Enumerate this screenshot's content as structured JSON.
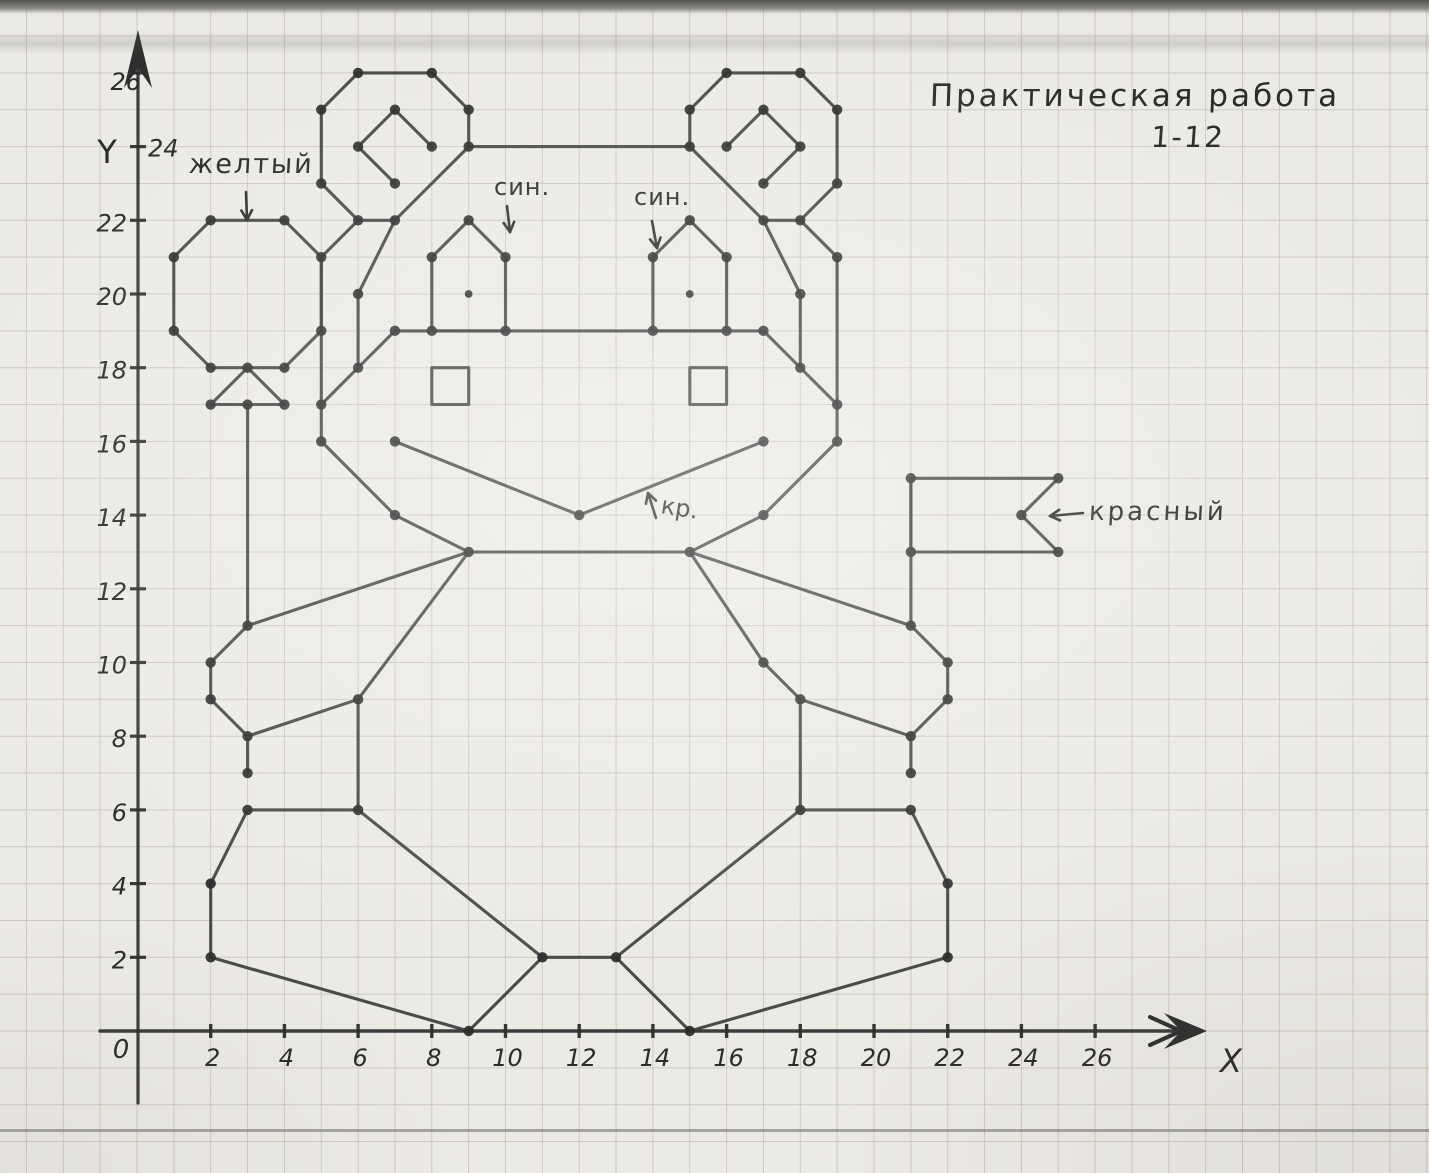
{
  "page": {
    "paper_color": "#eceae5",
    "grid_color": "#c8c5bf",
    "pencil_color": "#3a3a3a",
    "dot_color": "#2c2c2c",
    "text_color": "#2b2b2b"
  },
  "title": {
    "line1": "Практическая работа",
    "line2": "1-12"
  },
  "axes": {
    "x_letter": "X",
    "y_letter": "Y",
    "origin_label": "0",
    "x_tick_labels": [
      2,
      4,
      6,
      8,
      10,
      12,
      14,
      16,
      18,
      20,
      22,
      24,
      26
    ],
    "y_tick_labels": [
      2,
      4,
      6,
      8,
      10,
      12,
      14,
      16,
      18,
      20,
      22,
      24,
      26
    ],
    "origin_px": [
      137,
      1031
    ],
    "unit_px": 36.85
  },
  "annotations": [
    {
      "name": "label-yellow",
      "text": "желтый",
      "arrow": [
        [
          246,
          192
        ],
        [
          247,
          220
        ]
      ]
    },
    {
      "name": "label-blue-left",
      "text": "син.",
      "arrow": [
        [
          507,
          206
        ],
        [
          510,
          232
        ]
      ]
    },
    {
      "name": "label-blue-right",
      "text": "син.",
      "arrow": [
        [
          652,
          221
        ],
        [
          657,
          248
        ]
      ]
    },
    {
      "name": "label-red-mouth",
      "text": "кр.",
      "arrow": [
        [
          656,
          518
        ],
        [
          648,
          493
        ]
      ]
    },
    {
      "name": "label-red-flag",
      "text": "красный",
      "arrow": [
        [
          1083,
          513
        ],
        [
          1050,
          516
        ]
      ]
    }
  ],
  "chart_data": {
    "type": "line",
    "title": "Практическая работа 1-12",
    "description": "Hand-drawn connect-the-dots coordinate drawing on graph paper: a teddy bear holding a yellow balloon and a red flag",
    "xlabel": "X",
    "ylabel": "Y",
    "xlim": [
      0,
      29
    ],
    "ylim": [
      0,
      27
    ],
    "grid": true,
    "figures": [
      {
        "name": "balloon",
        "closed": true,
        "dots": true,
        "points": [
          [
            2,
            22
          ],
          [
            4,
            22
          ],
          [
            5,
            21
          ],
          [
            5,
            19
          ],
          [
            4,
            18
          ],
          [
            2,
            18
          ],
          [
            1,
            19
          ],
          [
            1,
            21
          ]
        ]
      },
      {
        "name": "balloon-knot",
        "closed": true,
        "dots": true,
        "points": [
          [
            3,
            18
          ],
          [
            4,
            17
          ],
          [
            2,
            17
          ]
        ]
      },
      {
        "name": "balloon-string",
        "closed": false,
        "dots": true,
        "points": [
          [
            3,
            17
          ],
          [
            3,
            11
          ]
        ]
      },
      {
        "name": "string-end-left",
        "closed": false,
        "dots": true,
        "points": [
          [
            3,
            8
          ],
          [
            3,
            7
          ]
        ]
      },
      {
        "name": "left-ear",
        "closed": true,
        "dots": true,
        "points": [
          [
            5,
            25
          ],
          [
            6,
            26
          ],
          [
            8,
            26
          ],
          [
            9,
            25
          ],
          [
            9,
            24
          ],
          [
            7,
            22
          ],
          [
            6,
            22
          ],
          [
            5,
            23
          ]
        ]
      },
      {
        "name": "left-ear-inner",
        "closed": false,
        "dots": true,
        "points": [
          [
            7,
            23
          ],
          [
            6,
            24
          ],
          [
            7,
            25
          ],
          [
            8,
            24
          ]
        ]
      },
      {
        "name": "right-ear",
        "closed": true,
        "dots": true,
        "points": [
          [
            15,
            25
          ],
          [
            16,
            26
          ],
          [
            18,
            26
          ],
          [
            19,
            25
          ],
          [
            19,
            23
          ],
          [
            18,
            22
          ],
          [
            17,
            22
          ],
          [
            15,
            24
          ]
        ]
      },
      {
        "name": "right-ear-inner",
        "closed": false,
        "dots": true,
        "points": [
          [
            17,
            23
          ],
          [
            18,
            24
          ],
          [
            17,
            25
          ],
          [
            16,
            24
          ]
        ]
      },
      {
        "name": "head-top",
        "closed": false,
        "dots": true,
        "points": [
          [
            9,
            24
          ],
          [
            15,
            24
          ]
        ]
      },
      {
        "name": "head-left",
        "closed": false,
        "dots": true,
        "points": [
          [
            6,
            22
          ],
          [
            5,
            21
          ],
          [
            5,
            16
          ],
          [
            7,
            14
          ],
          [
            9,
            13
          ]
        ]
      },
      {
        "name": "head-right",
        "closed": false,
        "dots": true,
        "points": [
          [
            18,
            22
          ],
          [
            19,
            21
          ],
          [
            19,
            16
          ],
          [
            17,
            14
          ],
          [
            15,
            13
          ]
        ]
      },
      {
        "name": "left-brow",
        "closed": false,
        "dots": true,
        "points": [
          [
            7,
            22
          ],
          [
            6,
            20
          ],
          [
            6,
            18
          ]
        ]
      },
      {
        "name": "left-cheek",
        "closed": false,
        "dots": true,
        "points": [
          [
            7,
            19
          ],
          [
            6,
            18
          ],
          [
            5,
            17
          ]
        ]
      },
      {
        "name": "right-brow",
        "closed": false,
        "dots": true,
        "points": [
          [
            17,
            22
          ],
          [
            18,
            20
          ],
          [
            18,
            18
          ]
        ]
      },
      {
        "name": "right-cheek",
        "closed": false,
        "dots": true,
        "points": [
          [
            17,
            19
          ],
          [
            18,
            18
          ],
          [
            19,
            17
          ]
        ]
      },
      {
        "name": "muzzle-top",
        "closed": false,
        "dots": true,
        "points": [
          [
            7,
            19
          ],
          [
            17,
            19
          ]
        ]
      },
      {
        "name": "left-eye",
        "closed": true,
        "dots": true,
        "points": [
          [
            8,
            19
          ],
          [
            8,
            21
          ],
          [
            9,
            22
          ],
          [
            10,
            21
          ],
          [
            10,
            19
          ]
        ]
      },
      {
        "name": "right-eye",
        "closed": true,
        "dots": true,
        "points": [
          [
            14,
            19
          ],
          [
            14,
            21
          ],
          [
            15,
            22
          ],
          [
            16,
            21
          ],
          [
            16,
            19
          ]
        ]
      },
      {
        "name": "left-nose-square",
        "closed": true,
        "dots": false,
        "points": [
          [
            8,
            17
          ],
          [
            9,
            17
          ],
          [
            9,
            18
          ],
          [
            8,
            18
          ]
        ]
      },
      {
        "name": "right-nose-square",
        "closed": true,
        "dots": false,
        "points": [
          [
            15,
            17
          ],
          [
            16,
            17
          ],
          [
            16,
            18
          ],
          [
            15,
            18
          ]
        ]
      },
      {
        "name": "mouth",
        "closed": false,
        "dots": true,
        "points": [
          [
            7,
            16
          ],
          [
            12,
            14
          ],
          [
            17,
            16
          ]
        ]
      },
      {
        "name": "chin",
        "closed": false,
        "dots": true,
        "points": [
          [
            9,
            13
          ],
          [
            15,
            13
          ]
        ]
      },
      {
        "name": "left-arm-top",
        "closed": false,
        "dots": true,
        "points": [
          [
            9,
            13
          ],
          [
            3,
            11
          ]
        ]
      },
      {
        "name": "left-paw",
        "closed": false,
        "dots": true,
        "points": [
          [
            3,
            11
          ],
          [
            2,
            10
          ],
          [
            2,
            9
          ],
          [
            3,
            8
          ]
        ]
      },
      {
        "name": "left-arm-inner",
        "closed": false,
        "dots": true,
        "points": [
          [
            3,
            8
          ],
          [
            6,
            9
          ],
          [
            9,
            13
          ]
        ]
      },
      {
        "name": "left-body-side",
        "closed": false,
        "dots": true,
        "points": [
          [
            6,
            9
          ],
          [
            6,
            6
          ]
        ]
      },
      {
        "name": "left-foot-top",
        "closed": false,
        "dots": true,
        "points": [
          [
            6,
            6
          ],
          [
            3,
            6
          ]
        ]
      },
      {
        "name": "left-foot-outer",
        "closed": false,
        "dots": true,
        "points": [
          [
            3,
            6
          ],
          [
            2,
            4
          ],
          [
            2,
            2
          ]
        ]
      },
      {
        "name": "left-foot-bottom",
        "closed": false,
        "dots": true,
        "points": [
          [
            2,
            2
          ],
          [
            9,
            0
          ],
          [
            11,
            2
          ]
        ]
      },
      {
        "name": "left-leg-inner",
        "closed": false,
        "dots": true,
        "points": [
          [
            11,
            2
          ],
          [
            6,
            6
          ]
        ]
      },
      {
        "name": "feet-middle",
        "closed": false,
        "dots": true,
        "points": [
          [
            11,
            2
          ],
          [
            13,
            2
          ]
        ]
      },
      {
        "name": "right-leg-inner",
        "closed": false,
        "dots": true,
        "points": [
          [
            13,
            2
          ],
          [
            18,
            6
          ]
        ]
      },
      {
        "name": "right-foot-bottom",
        "closed": false,
        "dots": true,
        "points": [
          [
            13,
            2
          ],
          [
            15,
            0
          ],
          [
            22,
            2
          ]
        ]
      },
      {
        "name": "right-foot-outer",
        "closed": false,
        "dots": true,
        "points": [
          [
            22,
            2
          ],
          [
            22,
            4
          ],
          [
            21,
            6
          ]
        ]
      },
      {
        "name": "right-foot-top",
        "closed": false,
        "dots": true,
        "points": [
          [
            21,
            6
          ],
          [
            18,
            6
          ]
        ]
      },
      {
        "name": "right-body-side",
        "closed": false,
        "dots": true,
        "points": [
          [
            18,
            6
          ],
          [
            18,
            9
          ]
        ]
      },
      {
        "name": "right-arm-inner",
        "closed": false,
        "dots": true,
        "points": [
          [
            21,
            8
          ],
          [
            18,
            9
          ],
          [
            17,
            10
          ],
          [
            15,
            13
          ]
        ]
      },
      {
        "name": "right-paw",
        "closed": false,
        "dots": true,
        "points": [
          [
            21,
            11
          ],
          [
            22,
            10
          ],
          [
            22,
            9
          ],
          [
            21,
            8
          ]
        ]
      },
      {
        "name": "right-arm-top",
        "closed": false,
        "dots": true,
        "points": [
          [
            15,
            13
          ],
          [
            21,
            11
          ]
        ]
      },
      {
        "name": "string-end-right",
        "closed": false,
        "dots": true,
        "points": [
          [
            21,
            8
          ],
          [
            21,
            7
          ]
        ]
      },
      {
        "name": "flag-pole",
        "closed": false,
        "dots": true,
        "points": [
          [
            21,
            15
          ],
          [
            21,
            11
          ]
        ]
      },
      {
        "name": "flag",
        "closed": true,
        "dots": true,
        "points": [
          [
            21,
            15
          ],
          [
            25,
            15
          ],
          [
            24,
            14
          ],
          [
            25,
            13
          ],
          [
            21,
            13
          ]
        ]
      }
    ],
    "extra_dots": [
      [
        5,
        19
      ],
      [
        5,
        17
      ],
      [
        19,
        17
      ],
      [
        3,
        17
      ],
      [
        21,
        13
      ]
    ],
    "pupils": [
      [
        9,
        20
      ],
      [
        15,
        20
      ]
    ]
  }
}
